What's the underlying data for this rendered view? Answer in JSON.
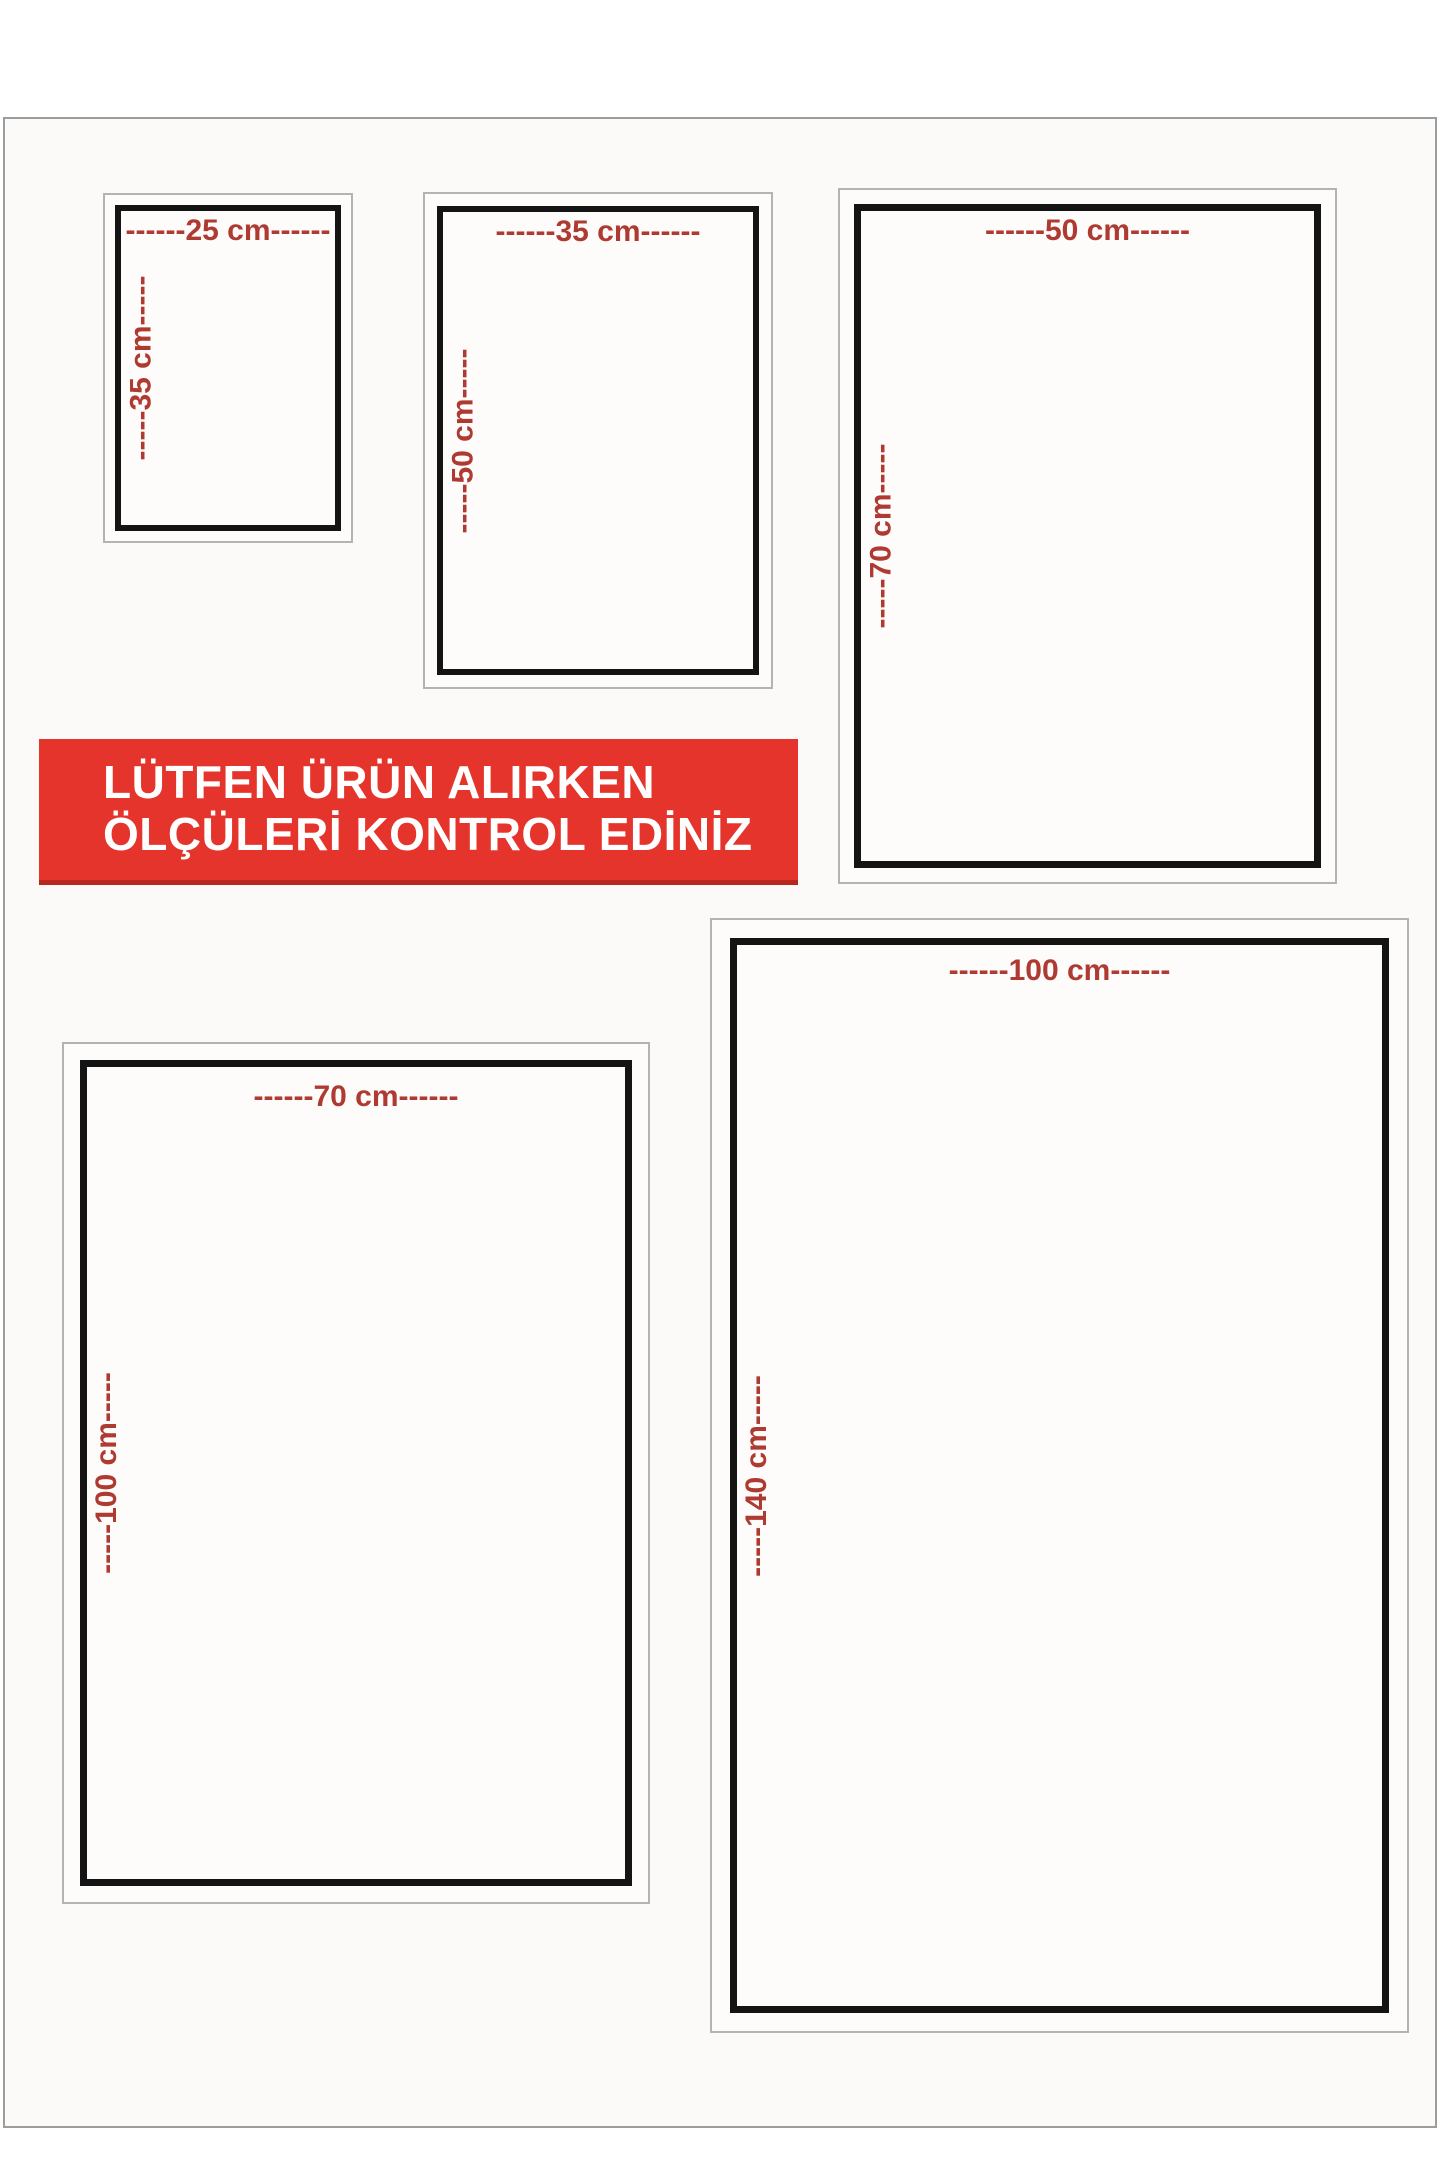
{
  "page": {
    "background": "#fbfaf9",
    "border_color": "#9c9c9c"
  },
  "banner": {
    "line1": "LÜTFEN ÜRÜN ALIRKEN",
    "line2": "ÖLÇÜLERİ KONTROL EDİNİZ",
    "bg_color": "#e5342b",
    "text_color": "#ffffff"
  },
  "label_color": "#ae3a32",
  "boxes": [
    {
      "name": "25x35",
      "width_cm": "25 cm",
      "height_cm": "35 cm",
      "top_label": "------25 cm------",
      "side_label": "-----35 cm-----"
    },
    {
      "name": "35x50",
      "width_cm": "35 cm",
      "height_cm": "50 cm",
      "top_label": "------35 cm------",
      "side_label": "-----50 cm-----"
    },
    {
      "name": "50x70",
      "width_cm": "50 cm",
      "height_cm": "70 cm",
      "top_label": "------50 cm------",
      "side_label": "-----70 cm-----"
    },
    {
      "name": "70x100",
      "width_cm": "70 cm",
      "height_cm": "100 cm",
      "top_label": "------70 cm------",
      "side_label": "-----100 cm-----"
    },
    {
      "name": "100x140",
      "width_cm": "100 cm",
      "height_cm": "140 cm",
      "top_label": "------100 cm------",
      "side_label": "-----140 cm-----"
    }
  ]
}
